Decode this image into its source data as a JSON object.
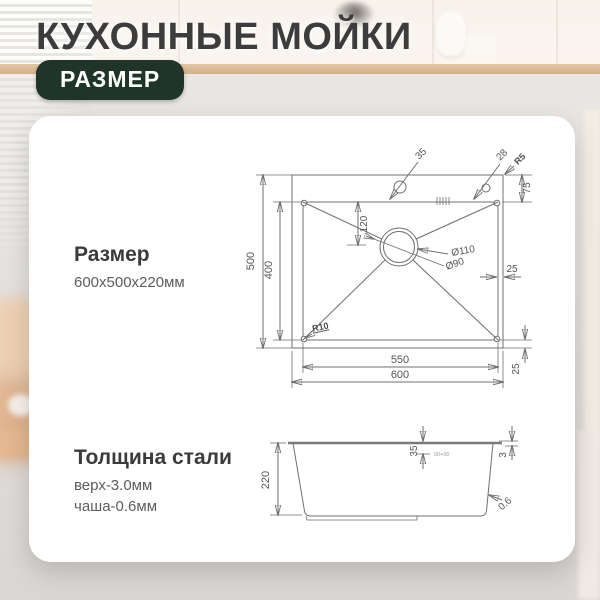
{
  "header": {
    "title": "КУХОННЫЕ МОЙКИ",
    "badge": "РАЗМЕР"
  },
  "card": {
    "size": {
      "heading": "Размер",
      "value": "600x500x220мм"
    },
    "thickness": {
      "heading": "Толщина стали",
      "lines": [
        "верх-3.0мм",
        "чаша-0.6мм"
      ]
    }
  },
  "top_view": {
    "outer_width": "600",
    "inner_width": "550",
    "outer_height": "500",
    "inner_height": "400",
    "drain_offset": "120",
    "rim_top": "75",
    "rim_right": "25",
    "rim_bottom": "25",
    "faucet_hole": "35",
    "accessory_hole": "28",
    "outer_corner_radius": "R5",
    "bowl_corner_radius": "R10",
    "drain_outer_diameter": "Ø110",
    "drain_inner_diameter": "Ø90"
  },
  "side_view": {
    "height": "220",
    "ledge_depth": "35",
    "rim_thickness": "3",
    "wall_thickness": "0.6",
    "tolerance": "00+00"
  },
  "colors": {
    "badge_bg": "#1f3529",
    "line": "#6f6f6f",
    "title_text": "#3c3c3c"
  }
}
